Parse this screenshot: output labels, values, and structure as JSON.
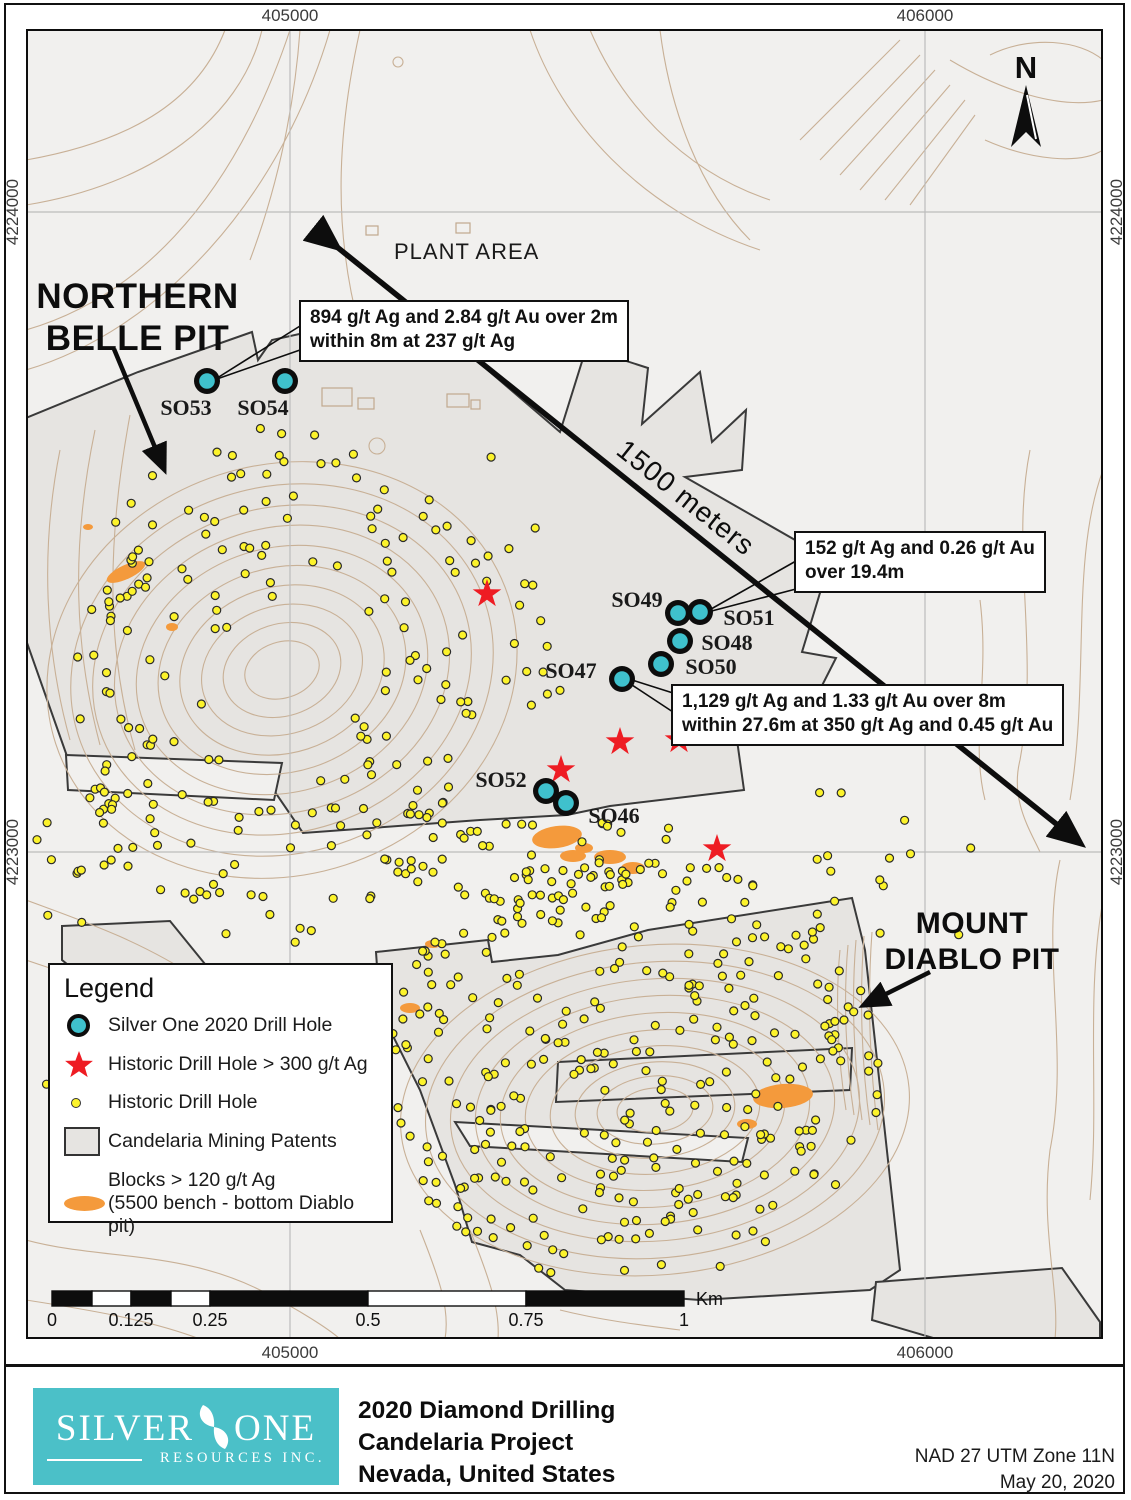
{
  "colors": {
    "map_bg": "#f1f0ee",
    "patent_fill": "#e6e4e1",
    "patent_stroke": "#3a3a3a",
    "contour": "#c8b096",
    "grid": "#bcbcbc",
    "teal": "#3fc1cd",
    "logo_teal": "#4bc0c8",
    "star_red": "#ee1c23",
    "dot_yellow": "#fcf32b",
    "orange": "#f49a3c"
  },
  "grid": {
    "x_labels": [
      "405000",
      "406000"
    ],
    "x_positions": [
      290,
      925
    ],
    "y_labels": [
      "4224000",
      "4223000"
    ],
    "y_positions": [
      212,
      852
    ]
  },
  "map_labels": {
    "north": "N",
    "plant_area": "PLANT AREA",
    "distance_arrow": "1500 meters",
    "northern_belle_line1": "NORTHERN",
    "northern_belle_line2": "BELLE PIT",
    "mount_diablo_line1": "MOUNT",
    "mount_diablo_line2": "DIABLO PIT"
  },
  "annotations": [
    {
      "id": "anno-so53",
      "lines": [
        "894 g/t Ag and 2.84 g/t Au over 2m",
        "within 8m at 237 g/t Ag"
      ]
    },
    {
      "id": "anno-so51",
      "lines": [
        "152 g/t Ag and 0.26 g/t Au",
        "over 19.4m"
      ]
    },
    {
      "id": "anno-so47",
      "lines": [
        "1,129 g/t Ag and 1.33 g/t Au over 8m",
        "within 27.6m at 350 g/t Ag and 0.45 g/t Au"
      ]
    }
  ],
  "drill_holes_2020": [
    {
      "id": "SO53",
      "x": 207,
      "y": 381,
      "lx": 186,
      "ly": 415
    },
    {
      "id": "SO54",
      "x": 285,
      "y": 381,
      "lx": 263,
      "ly": 415
    },
    {
      "id": "SO49",
      "x": 678,
      "y": 613,
      "lx": 637,
      "ly": 607
    },
    {
      "id": "SO51",
      "x": 700,
      "y": 612,
      "lx": 749,
      "ly": 625
    },
    {
      "id": "SO48",
      "x": 680,
      "y": 641,
      "lx": 727,
      "ly": 650
    },
    {
      "id": "SO50",
      "x": 661,
      "y": 664,
      "lx": 711,
      "ly": 674
    },
    {
      "id": "SO47",
      "x": 622,
      "y": 679,
      "lx": 571,
      "ly": 678
    },
    {
      "id": "SO52",
      "x": 546,
      "y": 791,
      "lx": 501,
      "ly": 787
    },
    {
      "id": "SO46",
      "x": 566,
      "y": 803,
      "lx": 614,
      "ly": 823
    }
  ],
  "historic_high_grade_stars": [
    [
      487,
      594
    ],
    [
      620,
      742
    ],
    [
      679,
      740
    ],
    [
      561,
      770
    ],
    [
      717,
      849
    ]
  ],
  "orange_blocks": [
    [
      126,
      572,
      21,
      7,
      -25
    ],
    [
      88,
      527,
      5,
      3,
      0
    ],
    [
      172,
      627,
      6,
      4,
      0
    ],
    [
      557,
      837,
      25,
      11,
      -8
    ],
    [
      584,
      848,
      9,
      5,
      0
    ],
    [
      573,
      856,
      13,
      6,
      0
    ],
    [
      610,
      857,
      16,
      7,
      0
    ],
    [
      633,
      868,
      12,
      6,
      0
    ],
    [
      783,
      1096,
      30,
      12,
      -5
    ],
    [
      747,
      1124,
      10,
      5,
      0
    ],
    [
      433,
      944,
      8,
      4,
      0
    ],
    [
      410,
      1008,
      10,
      5,
      0
    ]
  ],
  "dot_clusters": [
    {
      "name": "northern-belle-pit",
      "cx": 272,
      "cy": 688,
      "rx": 205,
      "ry": 262,
      "count": 195,
      "mode": "ring",
      "seed": 11
    },
    {
      "name": "northeast-scatter",
      "cx": 520,
      "cy": 620,
      "rx": 95,
      "ry": 115,
      "count": 18,
      "mode": "fill",
      "seed": 22
    },
    {
      "name": "mount-diablo-pit",
      "cx": 628,
      "cy": 1072,
      "rx": 255,
      "ry": 215,
      "count": 320,
      "mode": "fill",
      "seed": 33
    },
    {
      "name": "east-scatter",
      "cx": 885,
      "cy": 870,
      "rx": 95,
      "ry": 145,
      "count": 18,
      "mode": "fill",
      "seed": 44
    },
    {
      "name": "southwest-cluster",
      "cx": 95,
      "cy": 1060,
      "rx": 55,
      "ry": 78,
      "count": 24,
      "mode": "fill",
      "seed": 55
    },
    {
      "name": "west-scatter",
      "cx": 75,
      "cy": 870,
      "rx": 48,
      "ry": 62,
      "count": 10,
      "mode": "fill",
      "seed": 66
    },
    {
      "name": "central-band",
      "cx": 560,
      "cy": 865,
      "rx": 165,
      "ry": 62,
      "count": 60,
      "mode": "fill",
      "seed": 77
    },
    {
      "name": "upper-sparse",
      "cx": 465,
      "cy": 505,
      "rx": 60,
      "ry": 68,
      "count": 6,
      "mode": "fill",
      "seed": 88
    }
  ],
  "legend": {
    "title": "Legend",
    "items": [
      {
        "symbol": "silver-one-drill-hole",
        "label": "Silver One 2020 Drill Hole"
      },
      {
        "symbol": "historic-high-grade",
        "label": "Historic Drill Hole > 300 g/t Ag"
      },
      {
        "symbol": "historic-drill-hole",
        "label": "Historic Drill Hole"
      },
      {
        "symbol": "mining-patents",
        "label": "Candelaria Mining Patents"
      },
      {
        "symbol": "high-grade-blocks",
        "label": "Blocks > 120 g/t Ag",
        "label2": "(5500 bench - bottom Diablo pit)"
      }
    ]
  },
  "scalebar": {
    "unit": "Km",
    "labels": [
      "0",
      "0.125",
      "0.25",
      "0.5",
      "0.75",
      "1"
    ],
    "positions": [
      52,
      131,
      210,
      368,
      526,
      684
    ],
    "segments": [
      [
        52,
        92,
        "b"
      ],
      [
        92,
        131,
        "w"
      ],
      [
        131,
        171,
        "b"
      ],
      [
        171,
        210,
        "w"
      ],
      [
        210,
        368,
        "b"
      ],
      [
        368,
        526,
        "w"
      ],
      [
        526,
        684,
        "b"
      ]
    ],
    "bar_y": 1291,
    "bar_h": 15
  },
  "footer": {
    "logo_word1": "SILVER",
    "logo_word2": "ONE",
    "logo_sub": "RESOURCES INC.",
    "title_line1": "2020 Diamond Drilling",
    "title_line2": "Candelaria Project",
    "title_line3": "Nevada, United States",
    "datum": "NAD 27 UTM Zone 11N",
    "date": "May 20, 2020"
  }
}
